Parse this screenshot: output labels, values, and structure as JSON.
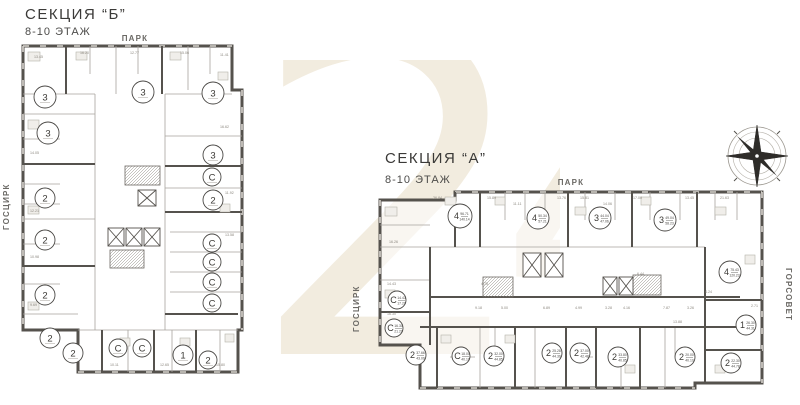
{
  "watermark": {
    "text": "24",
    "color": "#f2ecdf"
  },
  "compass": {
    "name": "compass-rose"
  },
  "sections": {
    "b": {
      "title": "СЕКЦИЯ “Б”",
      "subtitle": "8-10 ЭТАЖ",
      "street_top": "ПАРК",
      "street_left": "ГОСЦИРК",
      "apartments": [
        {
          "t": "3",
          "a1": "",
          "a2": "",
          "x": 25,
          "y": 53,
          "r": 11
        },
        {
          "t": "3",
          "a1": "",
          "a2": "",
          "x": 123,
          "y": 48,
          "r": 11
        },
        {
          "t": "3",
          "a1": "",
          "a2": "",
          "x": 193,
          "y": 49,
          "r": 11
        },
        {
          "t": "3",
          "a1": "",
          "a2": "",
          "x": 28,
          "y": 89,
          "r": 11
        },
        {
          "t": "3",
          "a1": "",
          "a2": "",
          "x": 193,
          "y": 111,
          "r": 10
        },
        {
          "t": "С",
          "a1": "",
          "a2": "",
          "x": 192,
          "y": 133,
          "r": 9
        },
        {
          "t": "2",
          "a1": "",
          "a2": "",
          "x": 193,
          "y": 156,
          "r": 10
        },
        {
          "t": "2",
          "a1": "",
          "a2": "",
          "x": 25,
          "y": 154,
          "r": 10
        },
        {
          "t": "2",
          "a1": "",
          "a2": "",
          "x": 25,
          "y": 196,
          "r": 10
        },
        {
          "t": "С",
          "a1": "",
          "a2": "",
          "x": 192,
          "y": 199,
          "r": 9
        },
        {
          "t": "С",
          "a1": "",
          "a2": "",
          "x": 192,
          "y": 218,
          "r": 9
        },
        {
          "t": "С",
          "a1": "",
          "a2": "",
          "x": 192,
          "y": 238,
          "r": 9
        },
        {
          "t": "С",
          "a1": "",
          "a2": "",
          "x": 192,
          "y": 259,
          "r": 9
        },
        {
          "t": "2",
          "a1": "",
          "a2": "",
          "x": 25,
          "y": 251,
          "r": 10
        },
        {
          "t": "2",
          "a1": "",
          "a2": "",
          "x": 30,
          "y": 294,
          "r": 10
        },
        {
          "t": "2",
          "a1": "",
          "a2": "",
          "x": 53,
          "y": 309,
          "r": 10
        },
        {
          "t": "С",
          "a1": "",
          "a2": "",
          "x": 98,
          "y": 304,
          "r": 9
        },
        {
          "t": "С",
          "a1": "",
          "a2": "",
          "x": 122,
          "y": 304,
          "r": 9
        },
        {
          "t": "1",
          "a1": "",
          "a2": "",
          "x": 163,
          "y": 311,
          "r": 10
        },
        {
          "t": "2",
          "a1": "",
          "a2": "",
          "x": 188,
          "y": 316,
          "r": 9
        }
      ],
      "room_labels": [
        {
          "t": "13.45",
          "x": 14,
          "y": 14
        },
        {
          "t": "16.20",
          "x": 60,
          "y": 10
        },
        {
          "t": "12.77",
          "x": 110,
          "y": 10
        },
        {
          "t": "15.06",
          "x": 160,
          "y": 10
        },
        {
          "t": "11.41",
          "x": 200,
          "y": 12
        },
        {
          "t": "14.05",
          "x": 10,
          "y": 110
        },
        {
          "t": "12.21",
          "x": 10,
          "y": 168
        },
        {
          "t": "10.98",
          "x": 10,
          "y": 214
        },
        {
          "t": "9.69",
          "x": 10,
          "y": 262
        },
        {
          "t": "16.62",
          "x": 200,
          "y": 84
        },
        {
          "t": "11.92",
          "x": 205,
          "y": 150
        },
        {
          "t": "13.58",
          "x": 205,
          "y": 192
        },
        {
          "t": "10.11",
          "x": 90,
          "y": 322
        },
        {
          "t": "12.65",
          "x": 140,
          "y": 322
        },
        {
          "t": "15.80",
          "x": 196,
          "y": 322
        }
      ]
    },
    "a": {
      "title": "СЕКЦИЯ “А”",
      "subtitle": "8-10 ЭТАЖ",
      "street_top": "ПАРК",
      "street_left": "ГОСЦИРК",
      "street_right": "ГОРСОВЕТ",
      "apartments": [
        {
          "t": "4",
          "a1": "96.71",
          "a2": "140.14",
          "x": 85,
          "y": 31,
          "r": 12
        },
        {
          "t": "4",
          "a1": "50.34",
          "a2": "57.21",
          "x": 163,
          "y": 33,
          "r": 11
        },
        {
          "t": "3",
          "a1": "44.04",
          "a2": "47.06",
          "x": 225,
          "y": 33,
          "r": 11
        },
        {
          "t": "3",
          "a1": "49.04",
          "a2": "58.23",
          "x": 290,
          "y": 35,
          "r": 11
        },
        {
          "t": "4",
          "a1": "75.43",
          "a2": "120.23",
          "x": 355,
          "y": 87,
          "r": 11
        },
        {
          "t": "1",
          "a1": "26.30",
          "a2": "44.31",
          "x": 371,
          "y": 140,
          "r": 10
        },
        {
          "t": "2",
          "a1": "22.30",
          "a2": "44.78",
          "x": 356,
          "y": 178,
          "r": 10
        },
        {
          "t": "2",
          "a1": "20.00",
          "a2": "40.10",
          "x": 310,
          "y": 172,
          "r": 10
        },
        {
          "t": "2",
          "a1": "33.80",
          "a2": "40.85",
          "x": 243,
          "y": 172,
          "r": 10
        },
        {
          "t": "2",
          "a1": "37.00",
          "a2": "42.48",
          "x": 205,
          "y": 168,
          "r": 10
        },
        {
          "t": "2",
          "a1": "25.28",
          "a2": "44.39",
          "x": 177,
          "y": 168,
          "r": 10
        },
        {
          "t": "2",
          "a1": "32.00",
          "a2": "44.85",
          "x": 119,
          "y": 171,
          "r": 10
        },
        {
          "t": "С",
          "a1": "18.00",
          "a2": "40.10",
          "x": 86,
          "y": 171,
          "r": 9
        },
        {
          "t": "2",
          "a1": "37.66",
          "a2": "43.09",
          "x": 41,
          "y": 170,
          "r": 10
        },
        {
          "t": "С",
          "a1": "14.43",
          "a2": "17.20",
          "x": 22,
          "y": 115,
          "r": 9
        },
        {
          "t": "С",
          "a1": "16.30",
          "a2": "21.20",
          "x": 19,
          "y": 143,
          "r": 9
        }
      ],
      "room_labels": [
        {
          "t": "36.84",
          "x": 58,
          "y": 14
        },
        {
          "t": "15.89",
          "x": 112,
          "y": 14
        },
        {
          "t": "11.11",
          "x": 138,
          "y": 20
        },
        {
          "t": "13.76",
          "x": 182,
          "y": 14
        },
        {
          "t": "15.81",
          "x": 205,
          "y": 14
        },
        {
          "t": "14.06",
          "x": 228,
          "y": 20
        },
        {
          "t": "17.00",
          "x": 258,
          "y": 14
        },
        {
          "t": "13.45",
          "x": 310,
          "y": 14
        },
        {
          "t": "21.63",
          "x": 345,
          "y": 14
        },
        {
          "t": "16.26",
          "x": 14,
          "y": 58
        },
        {
          "t": "14.43",
          "x": 12,
          "y": 100
        },
        {
          "t": "16.30",
          "x": 12,
          "y": 130
        },
        {
          "t": "9.18",
          "x": 100,
          "y": 124
        },
        {
          "t": "5.00",
          "x": 126,
          "y": 124
        },
        {
          "t": "6.89",
          "x": 168,
          "y": 124
        },
        {
          "t": "4.99",
          "x": 200,
          "y": 124
        },
        {
          "t": "3.28",
          "x": 230,
          "y": 124
        },
        {
          "t": "4.16",
          "x": 248,
          "y": 124
        },
        {
          "t": "7.87",
          "x": 288,
          "y": 124
        },
        {
          "t": "3.26",
          "x": 312,
          "y": 124
        },
        {
          "t": "13.88",
          "x": 298,
          "y": 138
        },
        {
          "t": "2.71",
          "x": 376,
          "y": 122
        },
        {
          "t": "4.75",
          "x": 106,
          "y": 100
        },
        {
          "t": "6.44",
          "x": 262,
          "y": 90
        },
        {
          "t": "4.24",
          "x": 330,
          "y": 108
        }
      ]
    }
  }
}
